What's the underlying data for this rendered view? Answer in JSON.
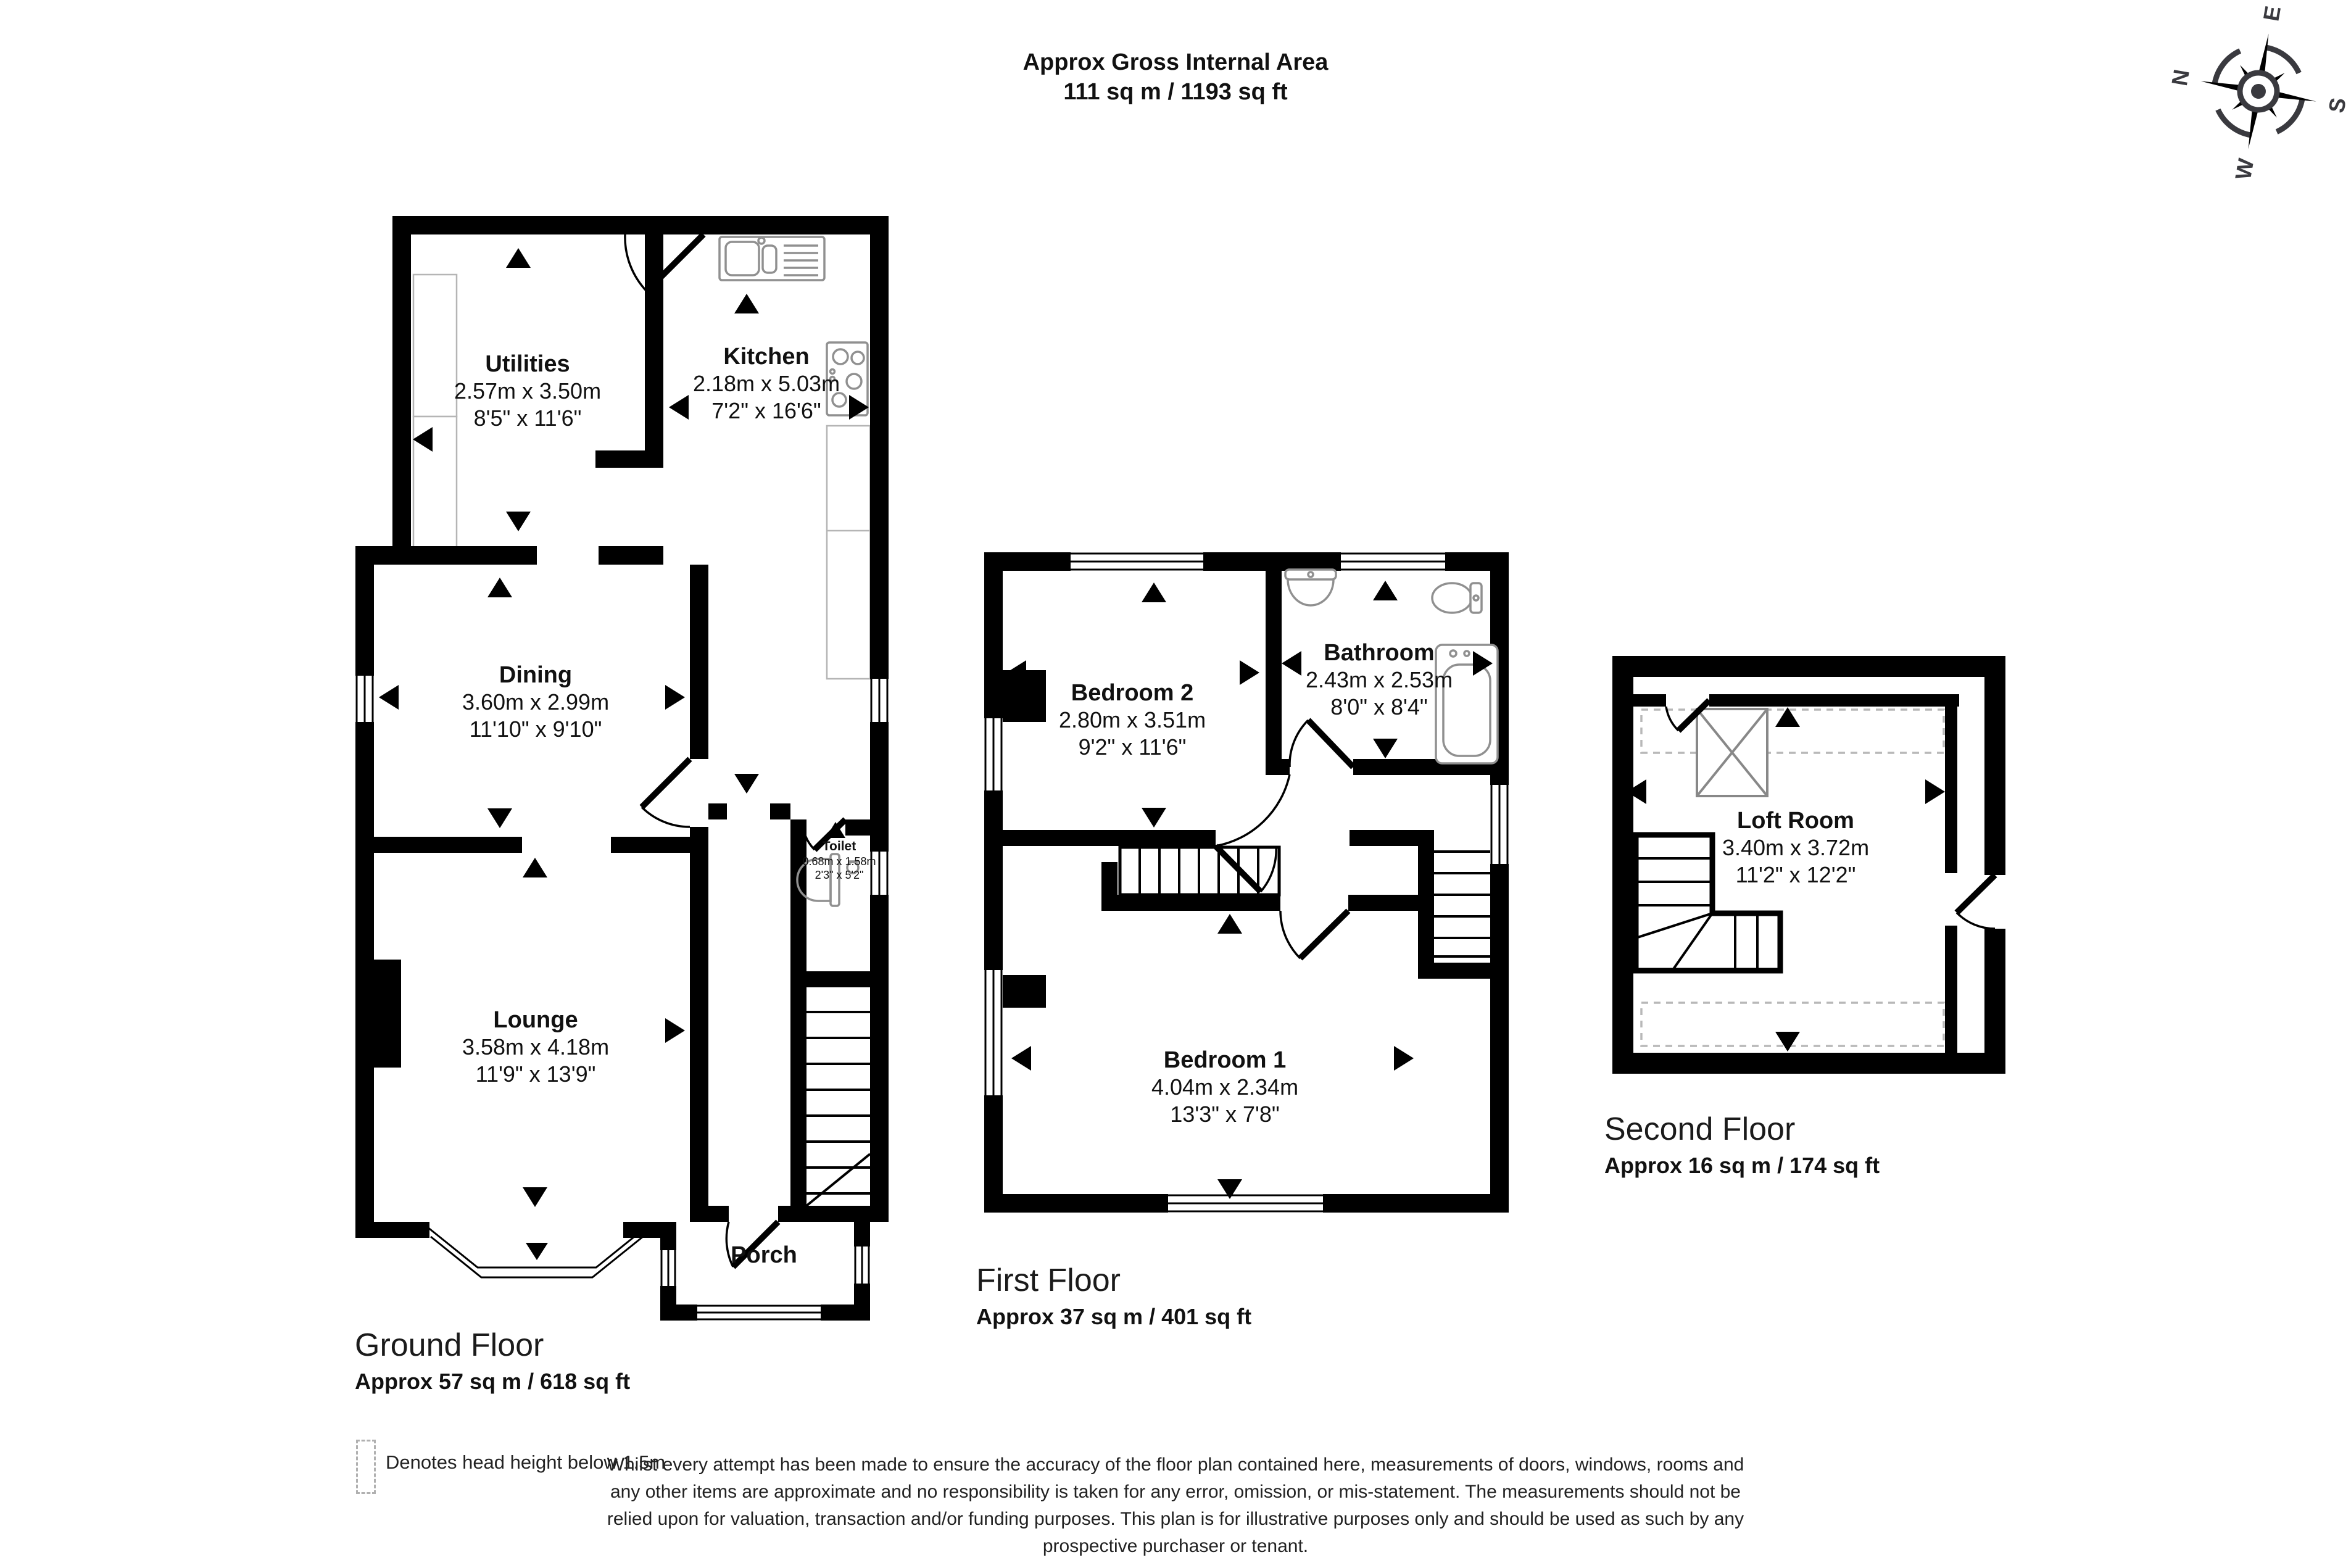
{
  "title": {
    "line1": "Approx Gross Internal Area",
    "line2": "111 sq m / 1193 sq ft"
  },
  "compass": {
    "north": "N",
    "east": "E",
    "south": "S",
    "west": "W"
  },
  "floors": {
    "ground": {
      "label": "Ground Floor",
      "area": "Approx 57 sq m / 618 sq ft",
      "rooms": {
        "utilities": {
          "name": "Utilities",
          "metric": "2.57m x 3.50m",
          "imperial": "8'5\" x 11'6\""
        },
        "kitchen": {
          "name": "Kitchen",
          "metric": "2.18m x 5.03m",
          "imperial": "7'2\" x 16'6\""
        },
        "dining": {
          "name": "Dining",
          "metric": "3.60m x 2.99m",
          "imperial": "11'10\" x 9'10\""
        },
        "lounge": {
          "name": "Lounge",
          "metric": "3.58m x 4.18m",
          "imperial": "11'9\" x 13'9\""
        },
        "toilet": {
          "name": "Toilet",
          "metric": "0.68m x 1.58m",
          "imperial": "2'3\" x 5'2\""
        },
        "porch": {
          "name": "Porch"
        }
      }
    },
    "first": {
      "label": "First Floor",
      "area": "Approx 37 sq m / 401 sq ft",
      "rooms": {
        "bedroom2": {
          "name": "Bedroom 2",
          "metric": "2.80m x 3.51m",
          "imperial": "9'2\" x 11'6\""
        },
        "bathroom": {
          "name": "Bathroom",
          "metric": "2.43m x 2.53m",
          "imperial": "8'0\" x 8'4\""
        },
        "bedroom1": {
          "name": "Bedroom 1",
          "metric": "4.04m x 2.34m",
          "imperial": "13'3\" x 7'8\""
        }
      }
    },
    "second": {
      "label": "Second Floor",
      "area": "Approx 16 sq m / 174 sq ft",
      "rooms": {
        "loft": {
          "name": "Loft Room",
          "metric": "3.40m x 3.72m",
          "imperial": "11'2\" x 12'2\""
        }
      }
    }
  },
  "legend": {
    "text": "Denotes head height below 1.5m"
  },
  "disclaimer": {
    "lines": [
      "Whilst every attempt has been made to ensure the accuracy of the floor plan contained here, measurements of doors, windows, rooms and",
      "any other items are approximate and no responsibility is taken for any error, omission, or mis-statement. The measurements should not be",
      "relied upon for valuation, transaction and/or funding purposes. This plan is for illustrative purposes only and should be used as such by any",
      "prospective purchaser or tenant."
    ]
  },
  "colors": {
    "wall": "#000000",
    "fixture": "#909090",
    "dashed": "#b8b8b8",
    "compass": "#3a3a3f"
  }
}
